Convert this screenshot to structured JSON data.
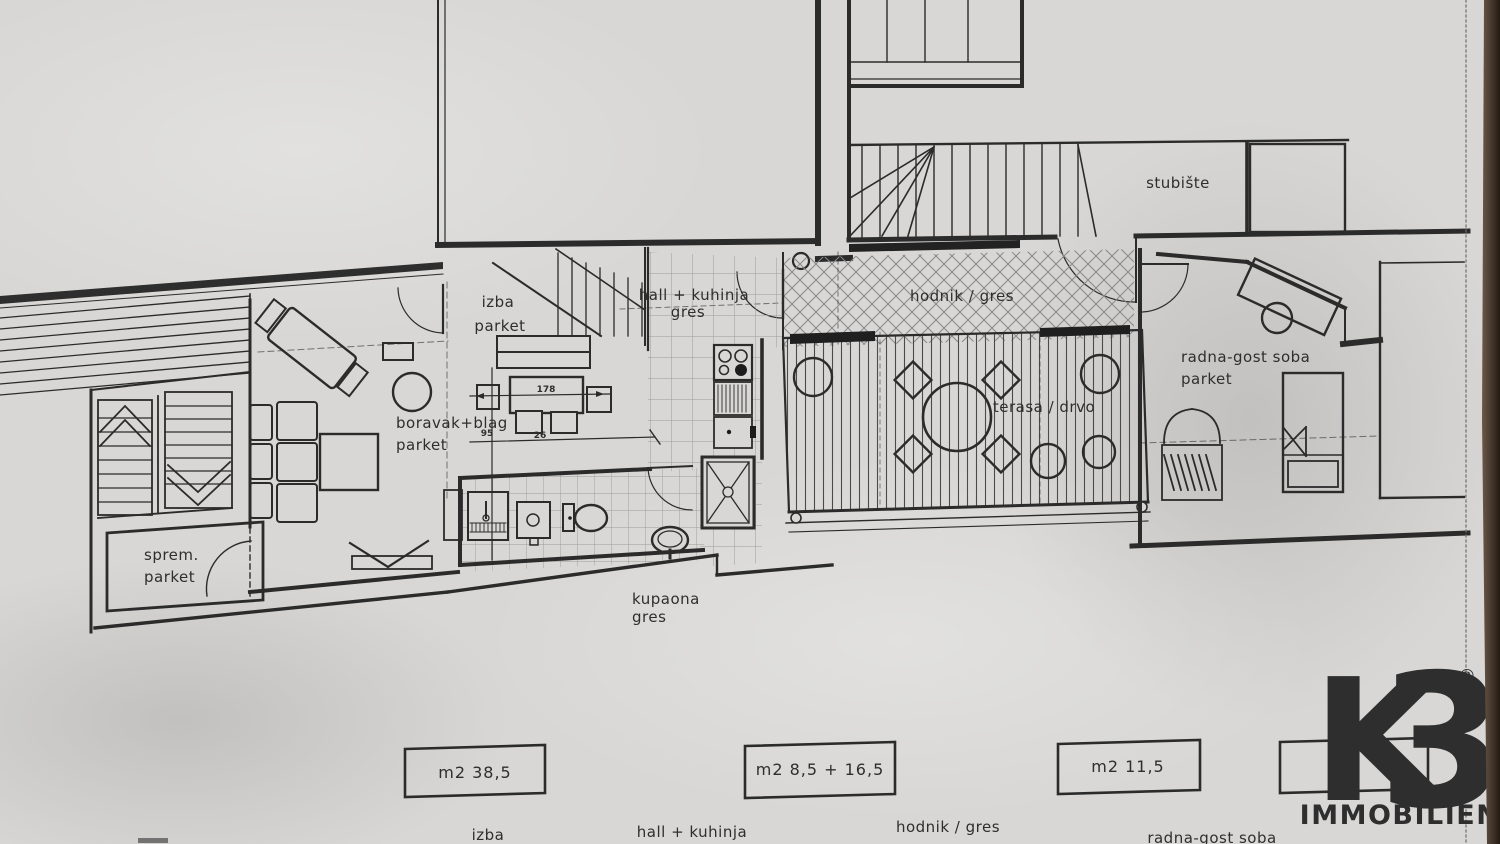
{
  "plan": {
    "rooms": {
      "izba": {
        "line1": "izba",
        "line2": "parket"
      },
      "hall": {
        "line1": "hall + kuhinja",
        "line2": "gres"
      },
      "hodnik": {
        "label": "hodnik / gres"
      },
      "stubiste": {
        "label": "stubište"
      },
      "terasa": {
        "label": "terasa / drvo"
      },
      "radna": {
        "line1": "radna-gost soba",
        "line2": "parket"
      },
      "boravak": {
        "line1": "boravak+blag",
        "line2": "parket"
      },
      "sprem": {
        "line1": "sprem.",
        "line2": "parket"
      },
      "kupaona": {
        "line1": "kupaona",
        "line2": "gres"
      }
    },
    "dimensions": {
      "dining_width": "178",
      "dining_depth": "95",
      "dining_offset": "26"
    }
  },
  "legend": {
    "items": [
      {
        "area": "m2  38,5",
        "room": "izba"
      },
      {
        "area": "m2  8,5 + 16,5",
        "room": "hall + kuhinja"
      },
      {
        "area": "m2 11,5",
        "room": "hodnik / gres"
      },
      {
        "area": "m2",
        "room": "radna-gost soba"
      }
    ]
  },
  "logo": {
    "k": "K",
    "three": "3",
    "registered": "®",
    "subtitle": "IMMOBILIEN"
  },
  "colors": {
    "paper": "#d8d7d5",
    "ink": "#2b2b2b",
    "logo_gray": "#8e8e90",
    "logo_red": "#e5332b",
    "photo_edge": "#3a2c20"
  }
}
